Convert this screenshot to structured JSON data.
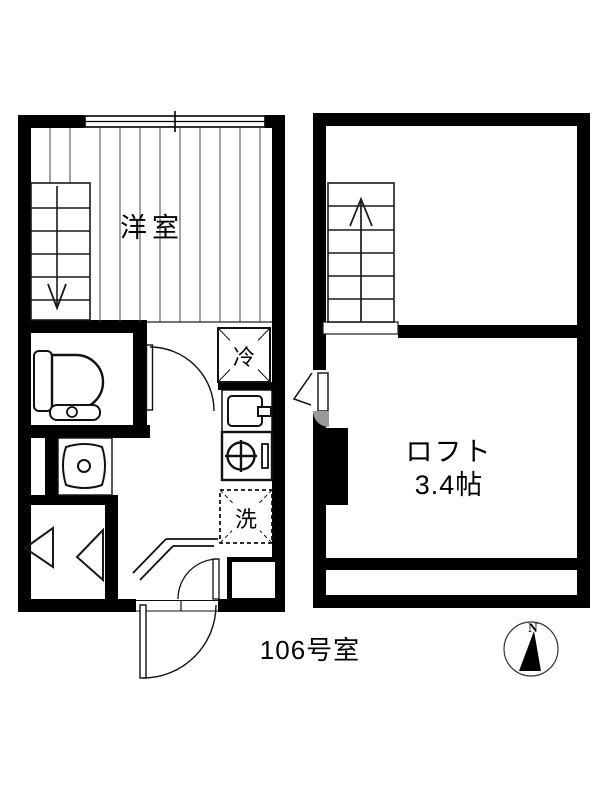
{
  "colors": {
    "wall": "#000000",
    "background": "#ffffff",
    "fixture_line": "#111111",
    "floor_line": "#4a4a4a",
    "shade": "#999999"
  },
  "first_floor": {
    "room_label": "洋室",
    "refrigerator_label": "冷",
    "washer_label": "洗"
  },
  "loft_floor": {
    "room_label": "ロフト",
    "room_size": "3.4帖"
  },
  "footer": {
    "room_number": "106号室"
  },
  "compass": {
    "north_label": "N"
  }
}
